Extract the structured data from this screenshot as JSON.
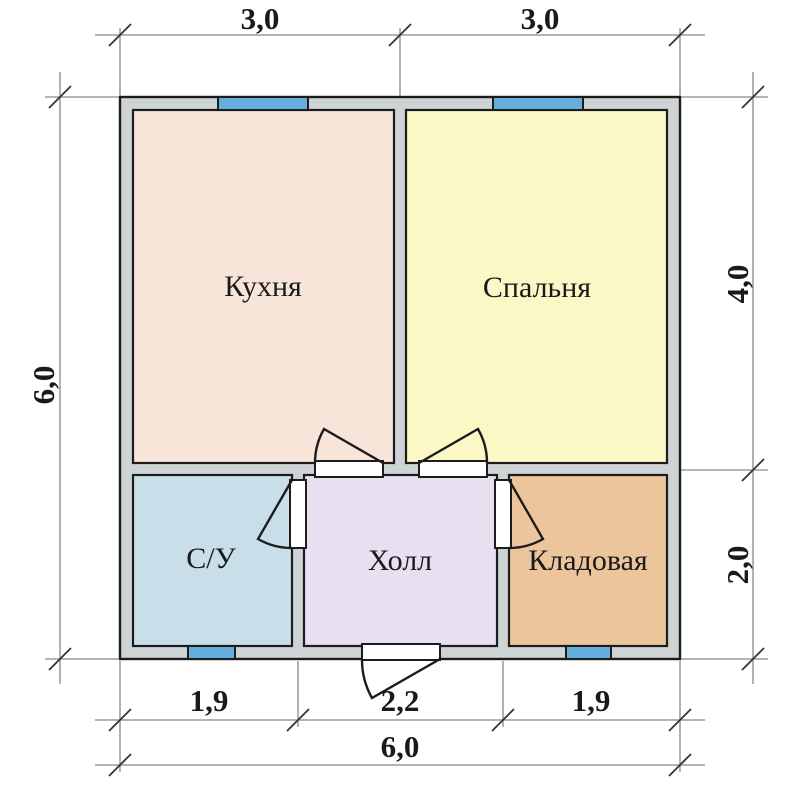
{
  "colors": {
    "background": "#ffffff",
    "wall_fill": "#ced3d6",
    "outline": "#1c1c1c",
    "kitchen_fill": "#f8e5da",
    "bedroom_fill": "#fcf8c6",
    "bathroom_fill": "#c8dfe9",
    "hall_fill": "#e7e0f1",
    "storage_fill": "#edc59c",
    "window_fill": "#63aedd",
    "door_gap_fill": "#ffffff",
    "dim_line": "#85898c",
    "tick": "#333333",
    "text": "#1a1a1a"
  },
  "rooms": [
    {
      "id": "kitchen",
      "label": "Кухня"
    },
    {
      "id": "bedroom",
      "label": "Спальня"
    },
    {
      "id": "bathroom",
      "label": "С/У"
    },
    {
      "id": "hall",
      "label": "Холл"
    },
    {
      "id": "storage",
      "label": "Кладовая"
    }
  ],
  "dimensions": {
    "top": [
      "3,0",
      "3,0"
    ],
    "left_total": "6,0",
    "right": [
      "4,0",
      "2,0"
    ],
    "bottom": [
      "1,9",
      "2,2",
      "1,9"
    ],
    "bottom_total": "6,0"
  }
}
